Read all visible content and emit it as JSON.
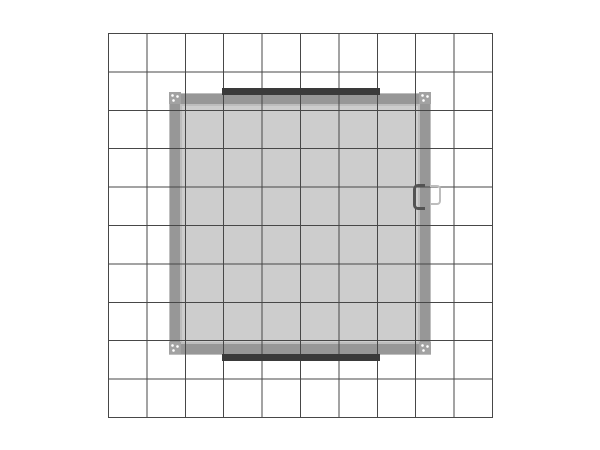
{
  "diagram": {
    "type": "plan-view-technical-drawing",
    "description": "Top-down plan view of a square exhibit structure centered on a 10 by 10 reference grid, with dark accent bars on the top and bottom outer edges, corner fittings at each frame corner, and a door handle detail on the right edge",
    "page_background": "#ffffff",
    "grid": {
      "columns": 10,
      "rows": 10,
      "line_color": "#474747"
    },
    "structure": {
      "fill_color": "#cdcdcd",
      "frame_color": "#979797",
      "frame_highlight_color": "#bdbdbd",
      "frame_outer_rim_color": "#bfbfbf",
      "bar_color": "#3a3a3a",
      "corner_fitting_color": "#a2a2a2",
      "handle_inner_color": "#535353",
      "handle_outer_color": "#bdbdbd"
    }
  }
}
